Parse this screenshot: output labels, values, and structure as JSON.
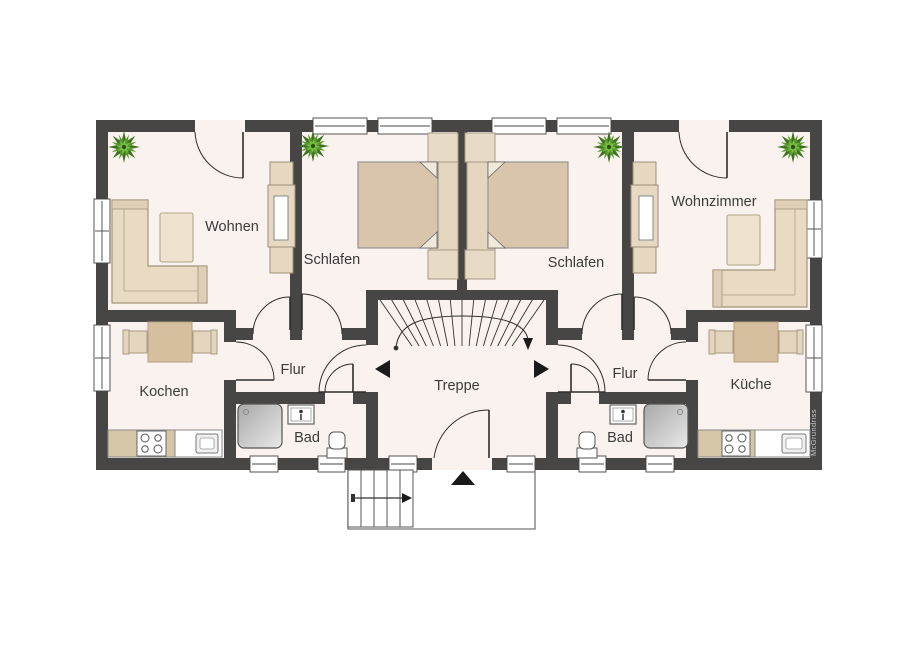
{
  "title": "Grundriss Obergeschoss",
  "rooms": {
    "wohnen": "Wohnen",
    "schlafen_links": "Schlafen",
    "schlafen_rechts": "Schlafen",
    "wohnzimmer": "Wohnzimmer",
    "kochen": "Kochen",
    "kueche": "Küche",
    "flur_links": "Flur",
    "flur_rechts": "Flur",
    "bad_links": "Bad",
    "bad_rechts": "Bad",
    "treppe": "Treppe"
  },
  "watermark": "McGrundriss",
  "icons": [
    "plant-icon",
    "shower-icon",
    "toilet-icon",
    "washbasin-icon",
    "stove-icon",
    "kitchen-sink-icon",
    "bed-icon",
    "sofa-icon",
    "wardrobe-icon",
    "stair-winder-icon",
    "entry-arrow-icon",
    "apartment-entry-marker-left",
    "apartment-entry-marker-right"
  ],
  "colors": {
    "wall": "#484644",
    "floor": "#f9f2ee",
    "furniture_light": "#e8dac3",
    "furniture_mid": "#d8c5ac",
    "furniture_table": "#d5bf9e",
    "counter": "#d6c6a8",
    "shower_gray": "#bdbdbd",
    "plant_green": "#569a2d",
    "line": "#333333",
    "marker_black": "#1a1a1a"
  }
}
